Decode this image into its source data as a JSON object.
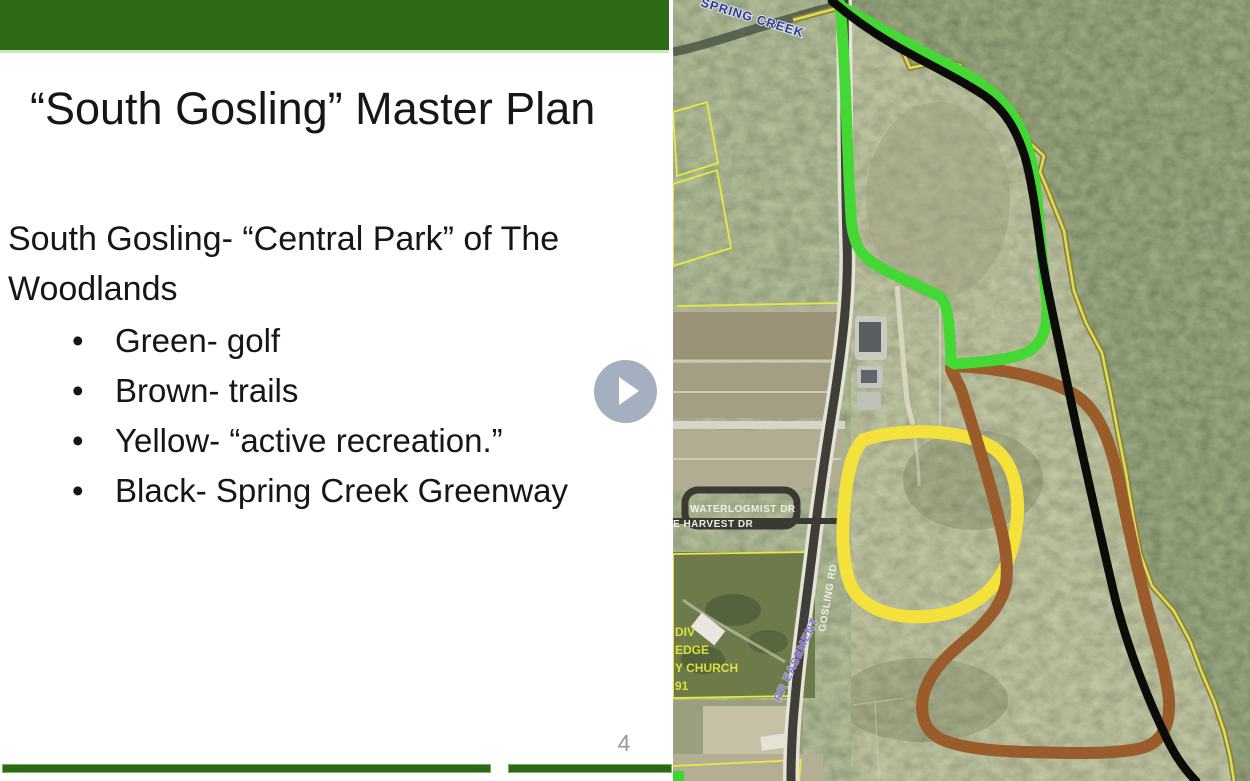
{
  "slide": {
    "title": "“South Gosling” Master Plan",
    "body_lines": [
      "South Gosling- “Central Park” of The",
      "Woodlands"
    ],
    "bullets": [
      "Green- golf",
      "Brown- trails",
      "Yellow- “active recreation.”",
      "Black- Spring Creek Greenway"
    ],
    "page_number": "4",
    "accent_color": "#2e6a17"
  },
  "player": {
    "play_symbol": "▶",
    "button_color": "#94a1b5"
  },
  "map": {
    "labels": {
      "creek": "SPRING CREEK",
      "waterlog": "WATERLOGMIST DR",
      "harvest": "E HARVEST DR",
      "gosling": "GOSLING RD",
      "easement": "RR EASEMENT",
      "church_lines": [
        "DIV",
        "EDGE",
        "Y CHURCH",
        "91"
      ]
    },
    "trails": {
      "green": {
        "name": "golf",
        "color": "#43d834"
      },
      "brown": {
        "name": "trails",
        "color": "#9a5c2a"
      },
      "yellow": {
        "name": "active recreation",
        "color": "#f4e13c"
      },
      "black": {
        "name": "Spring Creek Greenway",
        "color": "#0b0b09"
      },
      "boundary": {
        "name": "property boundary",
        "color": "#e0da5e"
      }
    }
  }
}
